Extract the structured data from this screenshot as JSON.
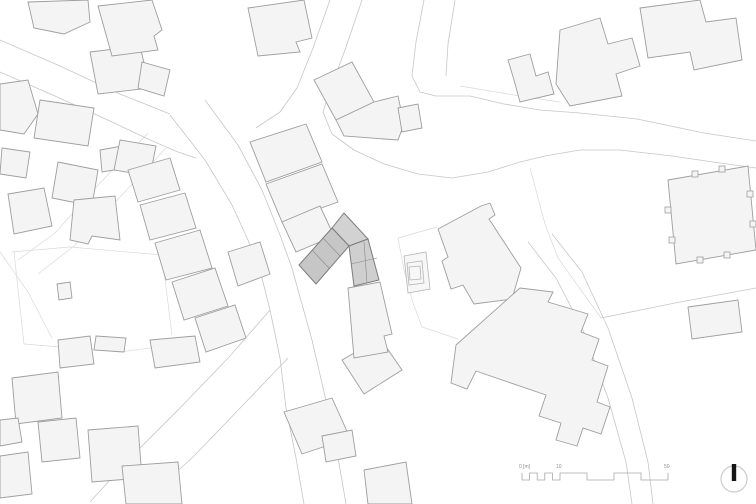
{
  "meta": {
    "title": "architectural-site-plan",
    "width": 756,
    "height": 504,
    "background": "#ffffff"
  },
  "palette": {
    "building_fill": "#f4f4f4",
    "building_stroke": "#9e9e9e",
    "road_stroke": "#c6c6c6",
    "parcel_stroke": "#d9d9d9",
    "ring_stroke": "#b5b5b5",
    "ring_fill": "#f7f7f7",
    "highlight_stroke": "#7c7c7c",
    "divider_stroke": "#8a8a8a",
    "scalebar_stroke": "#a8a8a8",
    "label_color": "#8f8f8f",
    "north_circle_stroke": "#cccccc",
    "north_needle_fill": "#161616"
  },
  "scalebar": {
    "path": "M522,473 L522,480 L529.6,480 L529.6,473 L537.2,473 L537.2,480 L544.8,480 L544.8,473 L552.4,473 L552.4,480 L560,480 L560,473 L587,473 L587,480 L614,480 L614,473 L641,473 L641,480 L668,480 L668,473",
    "labels": [
      {
        "text": "0 [m]",
        "x": 519,
        "y": 468
      },
      {
        "text": "10",
        "x": 556,
        "y": 468
      },
      {
        "text": "50",
        "x": 664,
        "y": 468
      }
    ]
  },
  "north": {
    "cx": 734,
    "cy": 479,
    "r": 13,
    "needle": {
      "x": 731.8,
      "y": 464,
      "w": 4.4,
      "h": 17
    }
  },
  "roads": [
    {
      "points": "0,40 60,66 120,94 170,114"
    },
    {
      "points": "0,72 55,96 112,122 150,140 178,152 196,158"
    },
    {
      "points": "170,115 205,160 232,205 248,240 262,278 270,310"
    },
    {
      "points": "205,100 238,145 262,190 280,235 292,268 298,290"
    },
    {
      "points": "330,0 313,48 297,88 280,112 256,128"
    },
    {
      "points": "362,0 345,50 330,90 323,112 332,134 354,150 384,164 418,174 452,178 488,172 520,162 545,156 580,150 620,150 672,156 720,163 756,168"
    },
    {
      "points": "436,96 470,96 504,104 540,110 580,113 637,119 704,133 756,141"
    },
    {
      "points": "424,0 416,42 412,76 420,92 436,96"
    },
    {
      "points": "455,0 448,44 446,76"
    },
    {
      "points": "270,310 230,356 180,408 128,460 90,502"
    },
    {
      "points": "288,358 244,404 194,456 142,504"
    },
    {
      "points": "270,310 280,358 286,408 296,458 304,504"
    },
    {
      "points": "298,290 312,340 324,392 336,446 346,504"
    },
    {
      "points": "528,242 556,278 583,330 608,398 626,462 632,504"
    },
    {
      "points": "552,234 582,272 608,328 632,398 648,462 653,504"
    },
    {
      "points": "601,318 680,302 756,288"
    }
  ],
  "parcels": [
    {
      "points": "398,238 437,227"
    },
    {
      "points": "398,238 404,270 413,303 422,327 458,339"
    },
    {
      "points": "530,168 545,224 558,258 601,318"
    },
    {
      "points": "12,252 70,247 162,255"
    },
    {
      "points": "162,255 172,335"
    },
    {
      "points": "14,252 24,344"
    },
    {
      "points": "24,344 120,352 194,342"
    },
    {
      "points": "148,133 100,183 55,233 18,260"
    },
    {
      "points": "166,148 120,197 74,246 38,274"
    },
    {
      "points": "0,252 28,292 52,338"
    },
    {
      "points": "460,86 520,96 560,102"
    }
  ],
  "buildings": [
    {
      "points": "28,2 88,0 90,22 64,34 34,28"
    },
    {
      "points": "0,84 28,80 38,114 24,134 0,130"
    },
    {
      "points": "90,52 140,46 150,88 98,94"
    },
    {
      "points": "142,62 170,70 164,96 138,88"
    },
    {
      "points": "98,6 152,0 162,30 154,36 158,50 112,56"
    },
    {
      "points": "2,148 30,152 26,178 0,174"
    },
    {
      "points": "40,100 94,108 88,146 34,138"
    },
    {
      "points": "58,162 98,170 92,206 52,198"
    },
    {
      "points": "8,194 44,188 52,226 14,234"
    },
    {
      "points": "74,200 115,196 120,240 92,236 88,244 70,240"
    },
    {
      "points": "100,150 122,146 126,168 102,172"
    },
    {
      "points": "120,140 156,146 150,176 114,170"
    },
    {
      "points": "57,284 70,282 72,298 59,300"
    },
    {
      "points": "128,170 170,158 180,190 138,202"
    },
    {
      "points": "140,205 185,193 196,228 150,240"
    },
    {
      "points": "155,243 200,230 212,268 166,280"
    },
    {
      "points": "172,282 215,268 228,306 184,320"
    },
    {
      "points": "195,318 235,305 246,338 206,352"
    },
    {
      "points": "228,252 260,242 270,274 238,286"
    },
    {
      "points": "150,340 195,336 200,362 155,368"
    },
    {
      "points": "12,378 58,372 62,418 16,424"
    },
    {
      "points": "58,340 90,336 94,364 60,368"
    },
    {
      "points": "38,422 76,418 80,458 42,462"
    },
    {
      "points": "88,430 138,426 142,478 92,482"
    },
    {
      "points": "0,420 18,418 22,442 0,446"
    },
    {
      "points": "0,456 28,452 32,494 0,498"
    },
    {
      "points": "122,466 178,462 182,504 126,504"
    },
    {
      "points": "96,336 126,338 124,352 94,350"
    },
    {
      "points": "250,142 306,124 322,162 266,182"
    },
    {
      "points": "266,184 322,164 338,202 282,222"
    },
    {
      "points": "282,222 320,206 334,236 296,252"
    },
    {
      "points": "248,8 304,0 312,38 296,42 300,52 258,56"
    },
    {
      "points": "314,80 352,62 374,102 336,120"
    },
    {
      "points": "336,120 374,102 398,96 404,124 398,140 344,136"
    },
    {
      "points": "398,108 418,104 422,128 402,132"
    },
    {
      "points": "508,60 530,54 536,76 548,72 554,94 520,102 514,80"
    },
    {
      "points": "560,30 600,18 608,44 632,38 640,66 616,74 622,96 570,106 556,84"
    },
    {
      "points": "640,8 700,0 706,22 736,18 742,60 694,70 690,52 648,58"
    },
    {
      "points": "668,180 748,166 756,250 676,264"
    },
    {
      "points": "438,229 481,206 490,203 495,215 489,219 521,268 512,299 474,304 463,285 451,289 442,261 448,257"
    },
    {
      "points": "456,345 520,288 553,292 548,302 588,314 581,332 599,339 592,360 608,366 597,402 610,407 601,434 583,428 577,446 556,440 561,423 539,416 546,395 476,371 467,389 451,383"
    },
    {
      "points": "342,360 380,338 402,370 364,394"
    },
    {
      "points": "284,412 332,398 350,438 302,454"
    },
    {
      "points": "348,288 380,282 392,334 384,336 388,352 354,358"
    },
    {
      "points": "364,470 406,462 412,504 368,504"
    },
    {
      "points": "322,436 352,430 356,456 326,462"
    },
    {
      "points": "688,307 738,300 742,332 692,339"
    }
  ],
  "church_bumps": [
    {
      "x": 692,
      "y": 171
    },
    {
      "x": 719,
      "y": 166
    },
    {
      "x": 665,
      "y": 207
    },
    {
      "x": 669,
      "y": 237
    },
    {
      "x": 747,
      "y": 191
    },
    {
      "x": 750,
      "y": 221
    },
    {
      "x": 697,
      "y": 257
    },
    {
      "x": 724,
      "y": 252
    }
  ],
  "rings": [
    {
      "points": "404,256 426,252 430,289 408,293"
    },
    {
      "points": "407,263 422,261 424,283 409,285"
    },
    {
      "points": "409,267 420,266 421,279 410,280"
    }
  ],
  "highlight": {
    "parts": [
      {
        "points": "332,228 344,213 368,239 349,246",
        "fill": "#d2d2d2"
      },
      {
        "points": "299,265 332,228 349,246 316,284",
        "fill": "#c6c6c6"
      },
      {
        "points": "349,246 368,239 379,280 354,286",
        "fill": "#cfcfcf"
      }
    ],
    "dividers": [
      {
        "points": "312,250 329,268"
      },
      {
        "points": "323,238 340,256"
      },
      {
        "points": "364,242 367,283"
      },
      {
        "points": "351,264 377,258"
      }
    ]
  }
}
